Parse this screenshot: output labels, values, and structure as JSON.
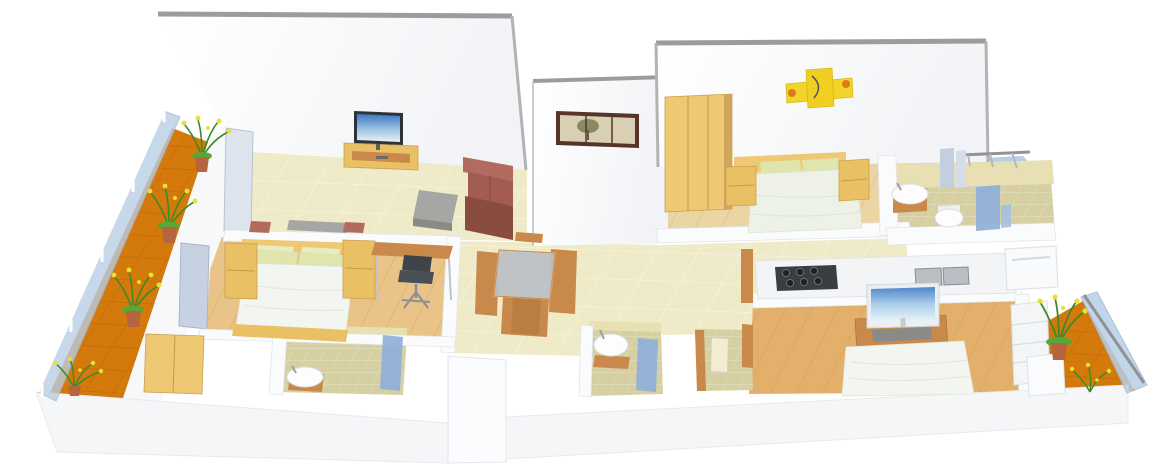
{
  "scene": {
    "type": "3d-floor-plan-render",
    "view": "isometric-cutaway",
    "background": "white",
    "text_labels": []
  },
  "colors": {
    "wall": "#fafbfc",
    "wall_shade": "#eef0f4",
    "wall_edge": "#9c9c9c",
    "tile_floor": "#efeac7",
    "wood_floor": "#e9c388",
    "wood_floor_mid": "#ecd5a4",
    "wood_floor_dark": "#e2b06a",
    "balcony_floor": "#d4790b",
    "bathroom_floor": "#d6cfa2",
    "bathroom_wall_tile": "#e8dfb2",
    "glass_railing": "#b9cee6",
    "partition_glass": "#8fb0da",
    "window_panel": "#dde4ee",
    "window_panel_dark": "#c6d2e2",
    "furniture_wood": "#e9c063",
    "furniture_wood_light": "#eec873",
    "furniture_wood_dark": "#c8894a",
    "furniture_wood_deep": "#b97f42",
    "sofa": "#a25c50",
    "sofa_light": "#b26b5f",
    "sofa_dark": "#8a4c3e",
    "duvet": "#f3f5f1",
    "duvet_green": "#eef2e6",
    "pillow_green": "#dfe5ac",
    "pillow_pale": "#e9ecc0",
    "plant_green": "#4f9a30",
    "flower_yellow": "#e8e032",
    "pot_terracotta": "#b5643e",
    "metal_gray": "#a6a6a4",
    "metal_gray_dark": "#8a8a88",
    "stove_black": "#3a3e42",
    "counter_white": "#f3f4f6",
    "steel_sink": "#b9bfc4",
    "white_fixture": "#fdfdfd",
    "art_yellow": "#f2d42a",
    "art_orange": "#e07818",
    "frame_brown": "#56342a",
    "picture_sepia": "#d9cfb4",
    "tree_olive": "#8a8a62",
    "tv_dark": "#2e3338",
    "tv_silver": "#eceef0",
    "shelf_white": "#f3f5f7",
    "front_wall": "#f5f6f8"
  },
  "rooms": [
    {
      "id": "balcony-left",
      "floor": "orange-tiles",
      "items": [
        "glass-railing",
        "potted-plant",
        "potted-plant",
        "potted-plant",
        "flower-cluster"
      ]
    },
    {
      "id": "living-room",
      "floor": "beige-tiles",
      "items": [
        "wall-tv",
        "tv-cabinet",
        "coffee-table",
        "sofa",
        "side-table",
        "accent-chair",
        "accent-chair"
      ]
    },
    {
      "id": "bedroom-1",
      "floor": "wood-planks",
      "items": [
        "double-bed",
        "nightstand",
        "nightstand",
        "study-desk",
        "office-chair",
        "wardrobe",
        "window-panels"
      ]
    },
    {
      "id": "bathroom-1",
      "floor": "olive-tiles",
      "items": [
        "wash-basin",
        "shower-partition"
      ]
    },
    {
      "id": "dining-area",
      "floor": "beige-tiles",
      "items": [
        "glass-top-dining-table",
        "dining-chair",
        "dining-chair",
        "dining-chair",
        "dining-chair"
      ]
    },
    {
      "id": "foyer-wall",
      "items": [
        "framed-tree-picture"
      ]
    },
    {
      "id": "bedroom-2",
      "floor": "wood-planks",
      "items": [
        "wardrobe",
        "double-bed",
        "nightstand",
        "nightstand",
        "abstract-wall-art"
      ]
    },
    {
      "id": "bathroom-2",
      "floor": "olive-tiles",
      "items": [
        "wash-basin",
        "toilet",
        "shower-partition",
        "window-panels"
      ]
    },
    {
      "id": "utility-balcony",
      "floor": "blue-glass",
      "items": [
        "railing"
      ]
    },
    {
      "id": "kitchen",
      "items": [
        "counter",
        "gas-hob",
        "double-steel-sink",
        "washing-machine",
        "door-frame"
      ]
    },
    {
      "id": "common-bathroom",
      "floor": "olive-tiles",
      "items": [
        "wash-basin",
        "shower-partition"
      ]
    },
    {
      "id": "toilet-room",
      "floor": "olive-tiles",
      "items": [
        "door-frame",
        "door-frame"
      ]
    },
    {
      "id": "bedroom-3",
      "floor": "wood-planks",
      "items": [
        "tv",
        "tv-cabinet",
        "double-bed",
        "shelf-unit",
        "door"
      ]
    },
    {
      "id": "balcony-right",
      "floor": "orange-tiles",
      "items": [
        "glass-railing",
        "potted-plant",
        "flower-cluster"
      ]
    }
  ]
}
